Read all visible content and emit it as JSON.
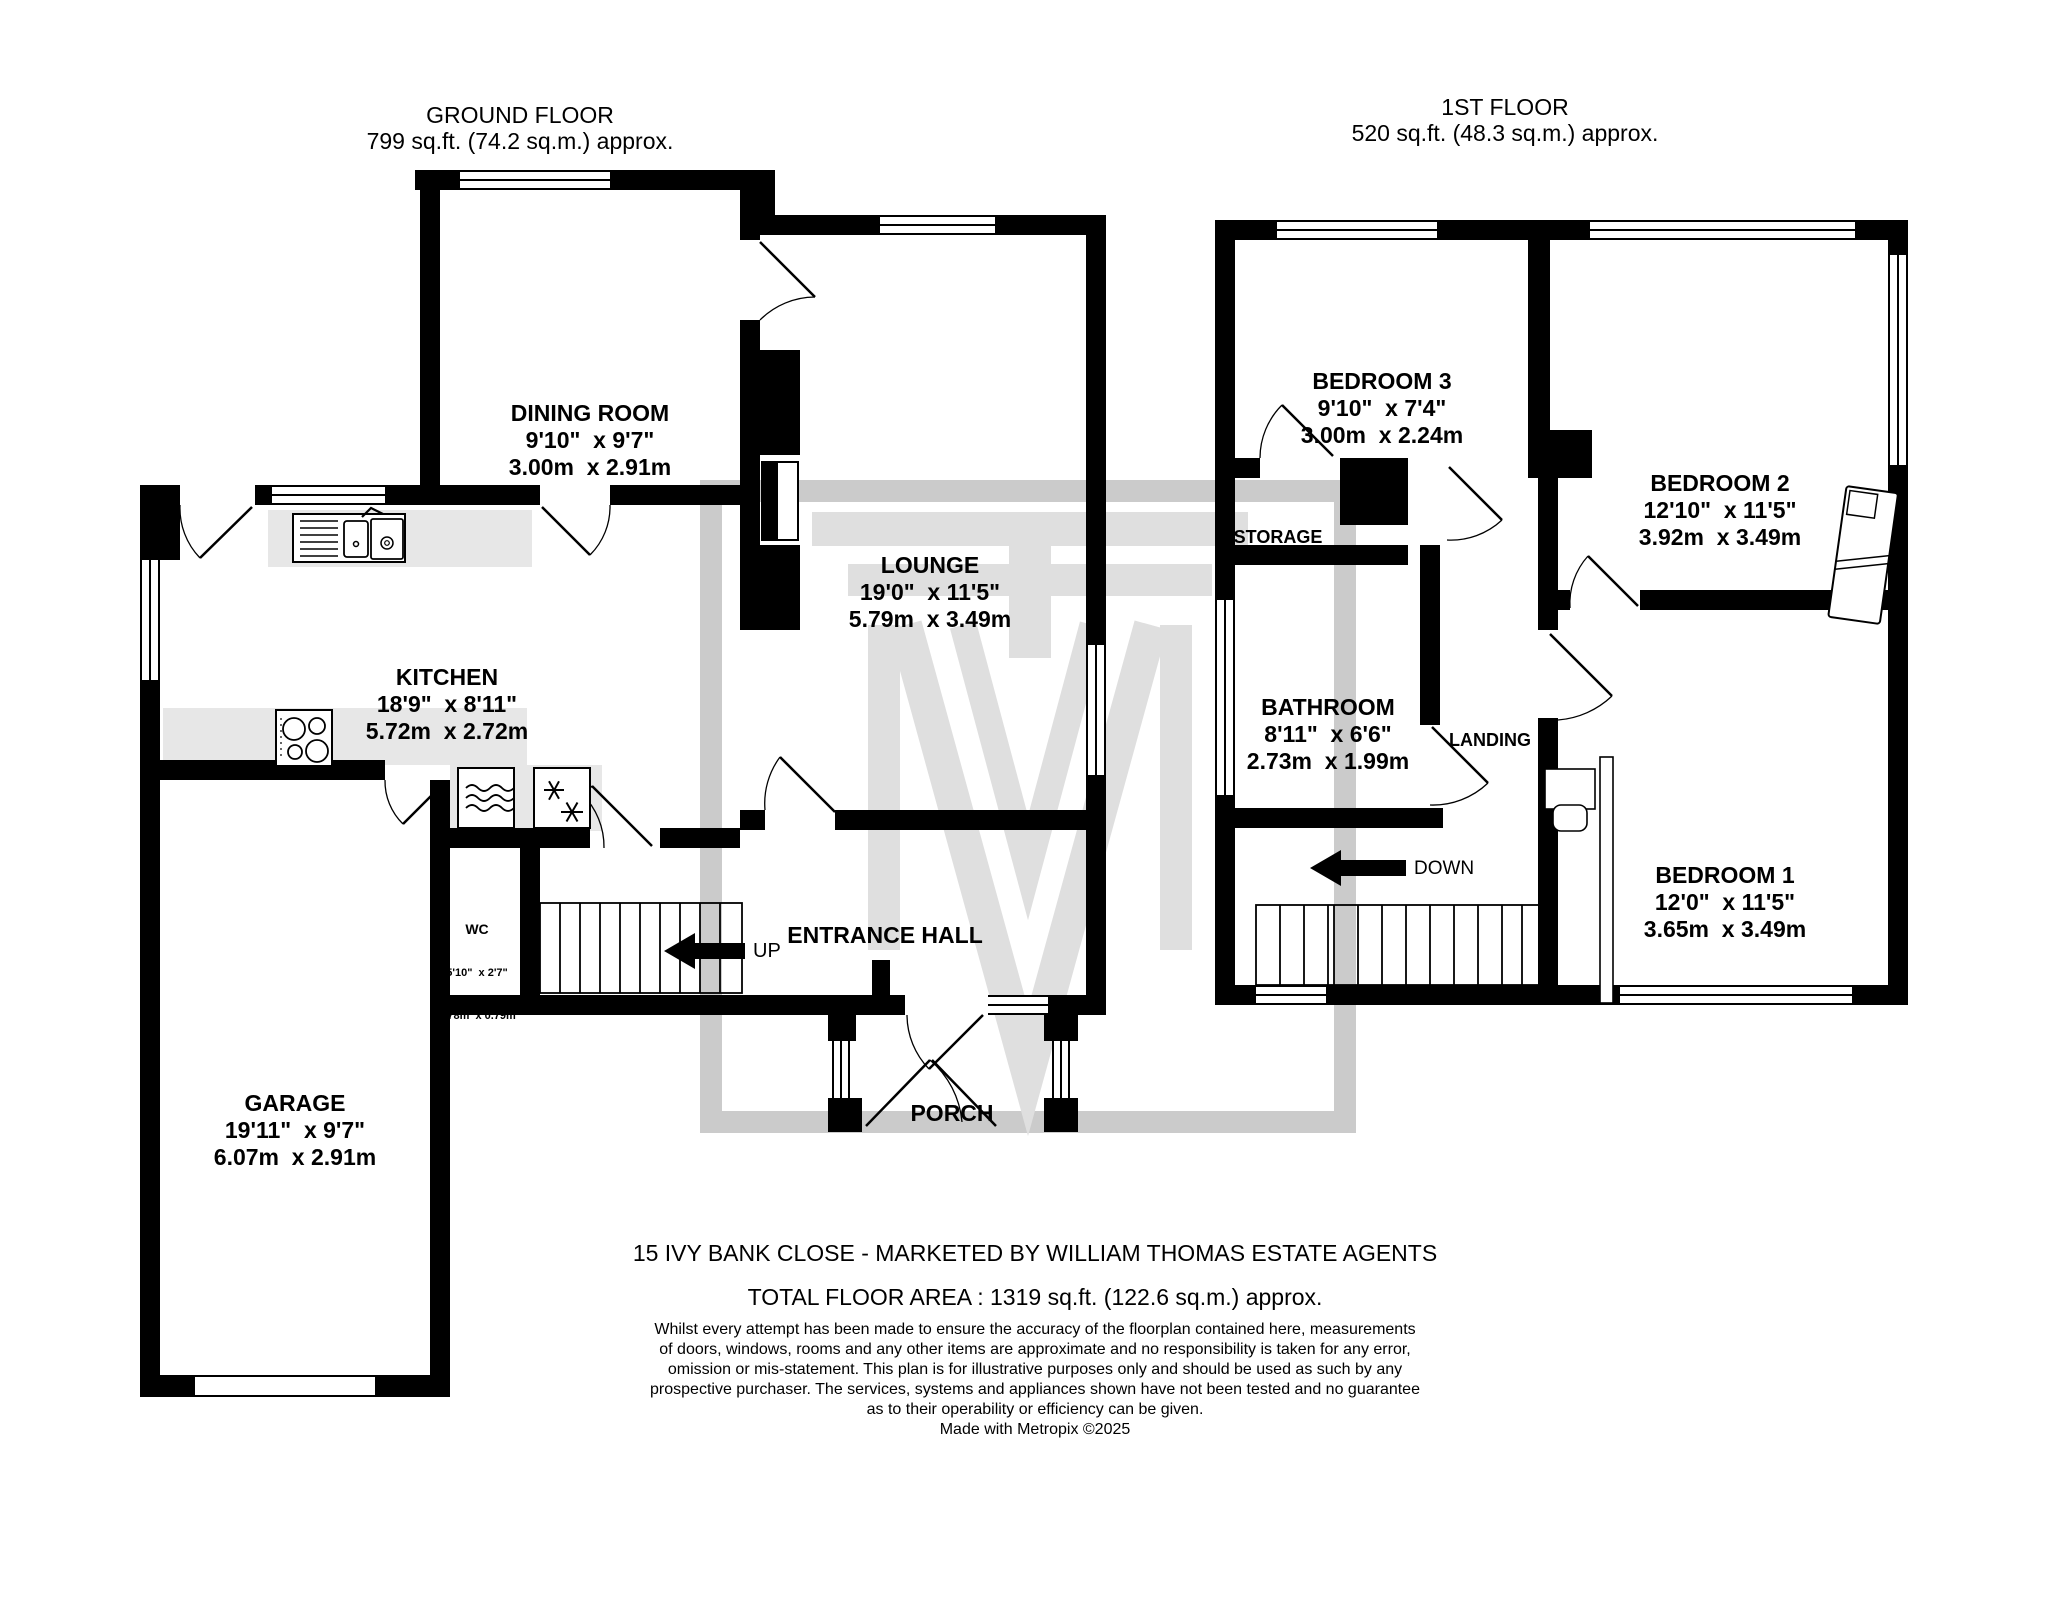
{
  "ground_floor": {
    "title": "GROUND FLOOR",
    "area": "799 sq.ft. (74.2 sq.m.) approx."
  },
  "first_floor": {
    "title": "1ST FLOOR",
    "area": "520 sq.ft. (48.3 sq.m.) approx."
  },
  "rooms": {
    "dining": {
      "name": "DINING ROOM",
      "imperial": "9'10\"  x 9'7\"",
      "metric": "3.00m  x 2.91m"
    },
    "lounge": {
      "name": "LOUNGE",
      "imperial": "19'0\"  x 11'5\"",
      "metric": "5.79m  x 3.49m"
    },
    "kitchen": {
      "name": "KITCHEN",
      "imperial": "18'9\"  x 8'11\"",
      "metric": "5.72m  x 2.72m"
    },
    "garage": {
      "name": "GARAGE",
      "imperial": "19'11\"  x 9'7\"",
      "metric": "6.07m  x 2.91m"
    },
    "wc": {
      "name": "WC",
      "imperial": "5'10\"  x 2'7\"",
      "metric": "1.78m  x 0.79m"
    },
    "entrance_hall": {
      "name": "ENTRANCE HALL"
    },
    "porch": {
      "name": "PORCH"
    },
    "bedroom1": {
      "name": "BEDROOM 1",
      "imperial": "12'0\"  x 11'5\"",
      "metric": "3.65m  x 3.49m"
    },
    "bedroom2": {
      "name": "BEDROOM 2",
      "imperial": "12'10\"  x 11'5\"",
      "metric": "3.92m  x 3.49m"
    },
    "bedroom3": {
      "name": "BEDROOM 3",
      "imperial": "9'10\"  x 7'4\"",
      "metric": "3.00m  x 2.24m"
    },
    "bathroom": {
      "name": "BATHROOM",
      "imperial": "8'11\"  x 6'6\"",
      "metric": "2.73m  x 1.99m"
    },
    "landing": {
      "name": "LANDING"
    },
    "storage": {
      "name": "STORAGE"
    }
  },
  "stairs": {
    "up": "UP",
    "down": "DOWN"
  },
  "footer": {
    "address_line": "15 IVY BANK CLOSE - MARKETED BY WILLIAM THOMAS ESTATE AGENTS",
    "total_area": "TOTAL FLOOR AREA : 1319 sq.ft. (122.6 sq.m.) approx.",
    "disclaimer_lines": [
      "Whilst every attempt has been made to ensure the accuracy of the floorplan contained here, measurements",
      "of doors, windows, rooms and any other items are approximate and no responsibility is taken for any error,",
      "omission or mis-statement. This plan is for illustrative purposes only and should be used as such by any",
      "prospective purchaser. The services, systems and appliances shown have not been tested and no guarantee",
      "as to their operability or efficiency can be given."
    ],
    "credit": "Made with Metropix ©2025"
  },
  "icons": {
    "sink": "sink-icon",
    "hob": "hob-icon",
    "washing_machine": "washing-machine-icon",
    "freezer": "freezer-icon",
    "bed": "bed-icon",
    "desk_chair": "desk-chair-icon",
    "up_arrow": "up-arrow-icon",
    "down_arrow": "down-arrow-icon",
    "watermark": "metropix-watermark-logo"
  },
  "colors": {
    "wall": "#000000",
    "counter": "#e7e7e7",
    "watermark_frame": "#c2c2c2",
    "watermark_logo": "#dadada",
    "text": "#000000",
    "background": "#ffffff"
  }
}
